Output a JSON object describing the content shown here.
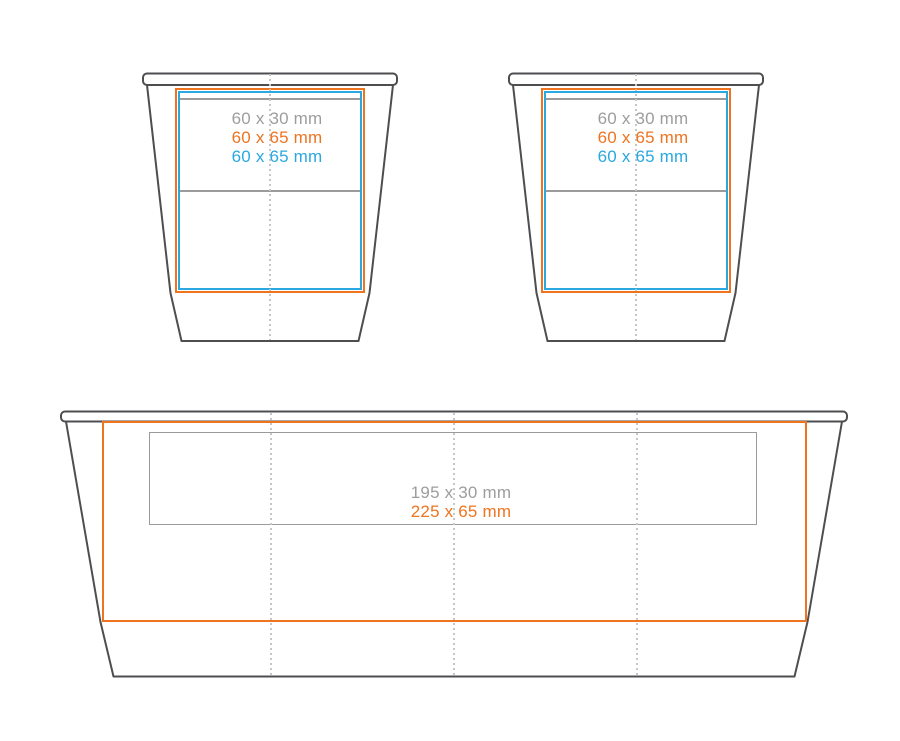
{
  "diagram": {
    "colors": {
      "outline": "#4e4e50",
      "gray_label": "#9d9d9c",
      "orange": "#ee7420",
      "blue": "#2aa9e1",
      "gray_guide": "#9b9b9b",
      "dashed_guide": "#c6c6c6"
    },
    "cup_view_1": {
      "gray_label": "60 x 30 mm",
      "orange_label": "60 x 65 mm",
      "blue_label": "60 x 65 mm"
    },
    "cup_view_2": {
      "gray_label": "60 x 30 mm",
      "orange_label": "60 x 65 mm",
      "blue_label": "60 x 65 mm"
    },
    "wrap_view": {
      "gray_label": "195 x 30 mm",
      "orange_label": "225 x 65 mm"
    }
  }
}
